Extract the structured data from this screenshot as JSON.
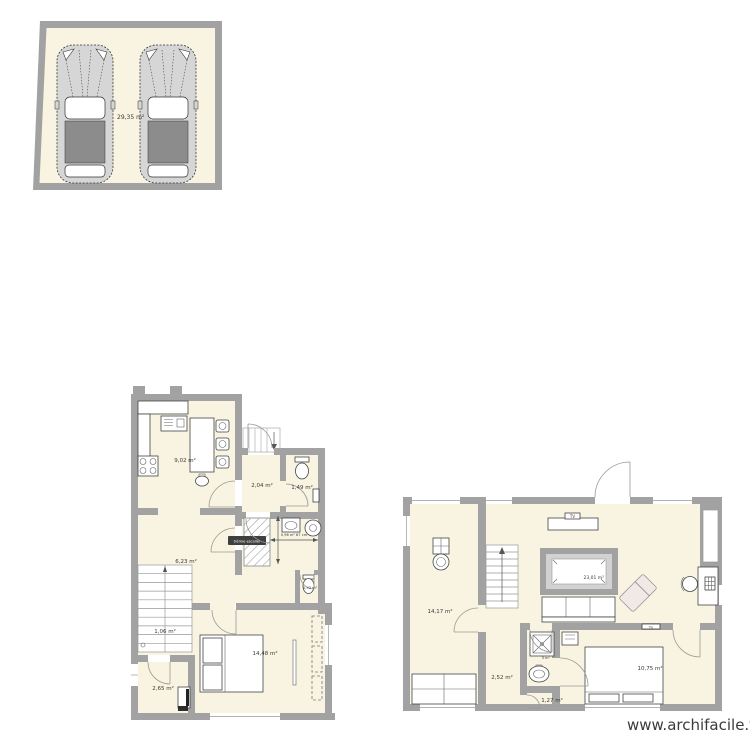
{
  "watermark": {
    "text": "www.archifacile.fr"
  },
  "colors": {
    "wall": "#a2a2a2",
    "floor": "#f8f4e1",
    "selected_bg": "#3f3f3f",
    "car_body": "#d6d6d6",
    "car_roof": "#8c8c8c",
    "billiard_inner": "#d2d2d2",
    "chaise": "#f2e8e6",
    "text": "#3a3a3a"
  },
  "garage": {
    "area": "29,35 m²"
  },
  "ground_floor": {
    "kitchen": {
      "area": "9,02 m²"
    },
    "entry": {
      "area": "2,04 m²"
    },
    "wc": {
      "area": "1,49 m²"
    },
    "hall": {
      "area": "6,23 m²"
    },
    "staircase": {
      "area": "1,06 m²"
    },
    "bedroom": {
      "area": "14,48 m²"
    },
    "storage": {
      "area": "2,65 m²"
    },
    "wc_small": {
      "area": "0,93 m²"
    },
    "stair_opening": {
      "selected_label": "trémie escalier",
      "dimension": "0,96 m² 87 cm"
    }
  },
  "first_floor": {
    "laundry": {
      "area": "14,17 m²"
    },
    "living": {
      "area": "23,01 m²"
    },
    "hall": {
      "area": "2,52 m²"
    },
    "shower": {
      "area": "3 m²"
    },
    "wc": {
      "area": "1,27 m²"
    },
    "bedroom": {
      "area": "10,75 m²"
    },
    "tv": {
      "label": "TV"
    },
    "tv_bedroom": {
      "label": "Tv"
    }
  }
}
